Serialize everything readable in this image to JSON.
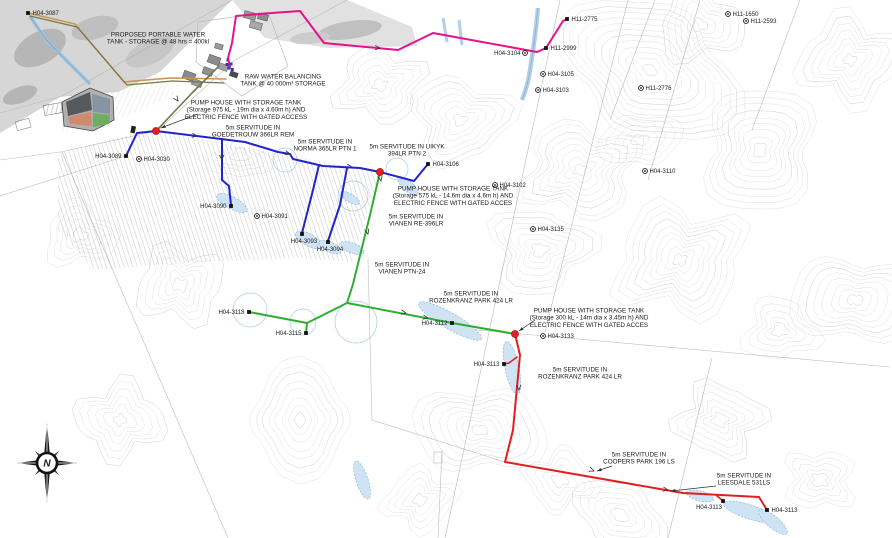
{
  "map": {
    "compass_label": "N",
    "colors": {
      "blue": "#2323cc",
      "green": "#2fae2f",
      "red": "#e02020",
      "pink": "#e6128c",
      "tan": "#c9964f",
      "olive": "#77774a",
      "junction": "#e02020",
      "marker": "#111111",
      "leader": "#333333"
    },
    "annotations": [
      {
        "id": "proposed-tank",
        "x": 158,
        "y": 31,
        "lines": [
          "PROPOSED PORTABLE WATER",
          "TANK - STORAGE @ 48 hrs = 400kl"
        ]
      },
      {
        "id": "raw-water-tank",
        "x": 283,
        "y": 73,
        "lines": [
          "RAW WATER BALANCING",
          "TANK @ 40 000m³ STORAGE"
        ]
      },
      {
        "id": "pump-house-1",
        "x": 246,
        "y": 99,
        "lines": [
          "PUMP HOUSE WITH STORAGE TANK",
          "(Storage 975 kL - 19m dia x 4.60m h) AND",
          "ELECTRIC FENCE WITH GATED ACCESS"
        ]
      },
      {
        "id": "servitude-goedetrouw",
        "x": 253,
        "y": 124,
        "lines": [
          "5m SERVITUDE IN",
          "GOEDETROUW 366LR REM"
        ]
      },
      {
        "id": "servitude-norma",
        "x": 325,
        "y": 138,
        "lines": [
          "5m SERVITUDE IN",
          "NORMA 365LR PTN 1"
        ]
      },
      {
        "id": "servitude-uikyk",
        "x": 407,
        "y": 143,
        "lines": [
          "5m SERVITUDE IN UIKYK",
          "394LR PTN 2"
        ]
      },
      {
        "id": "pump-house-2",
        "x": 453,
        "y": 185,
        "lines": [
          "PUMP HOUSE WITH STORAGE TANK",
          "(Storage 575 kL - 14.6m dia x 4.6m h) AND",
          "ELECTRIC FENCE WITH GATED ACCES"
        ]
      },
      {
        "id": "servitude-vianen-re",
        "x": 416,
        "y": 213,
        "lines": [
          "5m SERVITUDE IN",
          "VIANEN RE-396LR"
        ]
      },
      {
        "id": "servitude-vianen-ptn",
        "x": 402,
        "y": 261,
        "lines": [
          "5m SERVITUDE IN",
          "VIANEN PTN-24"
        ]
      },
      {
        "id": "servitude-rozenkranz-1",
        "x": 471,
        "y": 290,
        "lines": [
          "5m SERVITUDE IN",
          "ROZENKRANZ PARK 424 LR"
        ]
      },
      {
        "id": "pump-house-3",
        "x": 589,
        "y": 307,
        "lines": [
          "PUMP HOUSE WITH STORAGE TANK",
          "(Storage 300 kL - 14m dia x 3.45m h) AND",
          "ELECTRIC FENCE WITH GATED ACCES"
        ]
      },
      {
        "id": "servitude-rozenkranz-2",
        "x": 580,
        "y": 366,
        "lines": [
          "5m SERVITUDE IN",
          "ROZENKRANZ PARK 424 LR"
        ]
      },
      {
        "id": "servitude-coopers",
        "x": 639,
        "y": 451,
        "lines": [
          "5m SERVITUDE IN",
          "COOPERS PARK 196 LS"
        ]
      },
      {
        "id": "servitude-leesdale",
        "x": 744,
        "y": 472,
        "lines": [
          "5m SERVITUDE IN",
          "LEESDALE 531LS"
        ]
      }
    ],
    "markers": [
      {
        "label": "H04-3087",
        "x": 28,
        "y": 13,
        "type": "node",
        "side": "right"
      },
      {
        "label": "H11-2775",
        "x": 567,
        "y": 19,
        "type": "node",
        "side": "right"
      },
      {
        "label": "H11-1650",
        "x": 728,
        "y": 14,
        "type": "survey",
        "side": "right"
      },
      {
        "label": "H11-2593",
        "x": 746,
        "y": 21,
        "type": "survey",
        "side": "right"
      },
      {
        "label": "H11-2999",
        "x": 546,
        "y": 48,
        "type": "node",
        "side": "right"
      },
      {
        "label": "H04-3104",
        "x": 525,
        "y": 53,
        "type": "survey",
        "side": "left"
      },
      {
        "label": "H04-3105",
        "x": 543,
        "y": 74,
        "type": "survey",
        "side": "right"
      },
      {
        "label": "H04-3103",
        "x": 538,
        "y": 90,
        "type": "survey",
        "side": "right"
      },
      {
        "label": "H11-2776",
        "x": 641,
        "y": 88,
        "type": "survey",
        "side": "right"
      },
      {
        "label": "H04-3110",
        "x": 645,
        "y": 171,
        "type": "survey",
        "side": "right"
      },
      {
        "label": "H04-3089",
        "x": 126,
        "y": 156,
        "type": "node",
        "side": "left"
      },
      {
        "label": "H04-3030",
        "x": 139,
        "y": 159,
        "type": "survey",
        "side": "right"
      },
      {
        "label": "H04-3090",
        "x": 231,
        "y": 206,
        "type": "node",
        "side": "left"
      },
      {
        "label": "H04-3091",
        "x": 257,
        "y": 216,
        "type": "survey",
        "side": "right"
      },
      {
        "label": "H04-3093",
        "x": 302,
        "y": 234,
        "type": "node",
        "side": "below"
      },
      {
        "label": "H04-3094",
        "x": 328,
        "y": 242,
        "type": "node",
        "side": "below"
      },
      {
        "label": "H04-3106",
        "x": 428,
        "y": 164,
        "type": "node",
        "side": "right"
      },
      {
        "label": "H04-3102",
        "x": 495,
        "y": 185,
        "type": "survey",
        "side": "right"
      },
      {
        "label": "H04-3135",
        "x": 533,
        "y": 229,
        "type": "survey",
        "side": "right"
      },
      {
        "label": "H04-3118",
        "x": 249,
        "y": 312,
        "type": "node",
        "side": "left"
      },
      {
        "label": "H04-3115",
        "x": 306,
        "y": 333,
        "type": "node",
        "side": "left"
      },
      {
        "label": "H04-3112",
        "x": 452,
        "y": 323,
        "type": "node",
        "side": "left"
      },
      {
        "label": "H04-3133",
        "x": 543,
        "y": 336,
        "type": "survey",
        "side": "right"
      },
      {
        "label": "H04-3113",
        "x": 504,
        "y": 364,
        "type": "node",
        "side": "left"
      },
      {
        "label": "H04-3113",
        "x": 723,
        "y": 501,
        "type": "node",
        "side": "below-left"
      },
      {
        "label": "H04-3113",
        "x": 767,
        "y": 510,
        "type": "node",
        "side": "right"
      }
    ],
    "junctions": [
      {
        "x": 156,
        "y": 131
      },
      {
        "x": 380,
        "y": 172
      },
      {
        "x": 515,
        "y": 334
      }
    ],
    "pipelines": [
      {
        "name": "raw-line-tan",
        "color": "tan",
        "width": 1.6,
        "points": [
          [
            28,
            13
          ],
          [
            75,
            24
          ],
          [
            124,
            82
          ],
          [
            170,
            78
          ],
          [
            226,
            79
          ]
        ]
      },
      {
        "name": "raw-line-olive",
        "color": "olive",
        "width": 1.2,
        "points": [
          [
            30,
            16
          ],
          [
            77,
            27
          ],
          [
            127,
            85
          ],
          [
            172,
            81
          ],
          [
            224,
            83
          ]
        ]
      },
      {
        "name": "gravity-line",
        "color": "olive",
        "width": 1.6,
        "points": [
          [
            219,
            66
          ],
          [
            192,
            93
          ],
          [
            156,
            131
          ]
        ]
      },
      {
        "name": "rising-main-pink",
        "color": "pink",
        "width": 2,
        "points": [
          [
            230,
            67
          ],
          [
            228,
            58
          ],
          [
            232,
            43
          ],
          [
            236,
            16
          ],
          [
            272,
            13
          ],
          [
            300,
            11
          ],
          [
            324,
            43
          ],
          [
            398,
            50
          ],
          [
            433,
            33
          ],
          [
            537,
            52
          ],
          [
            546,
            48
          ],
          [
            563,
            21
          ],
          [
            567,
            19
          ]
        ]
      },
      {
        "name": "goedetrouw-main-blue",
        "color": "blue",
        "width": 2,
        "points": [
          [
            137,
            133
          ],
          [
            156,
            131
          ],
          [
            213,
            138
          ],
          [
            245,
            142
          ],
          [
            278,
            152
          ],
          [
            290,
            154
          ],
          [
            293,
            159
          ],
          [
            323,
            166
          ],
          [
            360,
            168
          ],
          [
            380,
            172
          ]
        ]
      },
      {
        "name": "blue-tail-uikyk",
        "color": "blue",
        "width": 2,
        "points": [
          [
            380,
            172
          ],
          [
            414,
            181
          ],
          [
            428,
            164
          ]
        ]
      },
      {
        "name": "blue-branch-3089",
        "color": "blue",
        "width": 2,
        "points": [
          [
            137,
            133
          ],
          [
            126,
            156
          ]
        ]
      },
      {
        "name": "blue-branch-3090",
        "color": "blue",
        "width": 2,
        "points": [
          [
            222,
            139
          ],
          [
            222,
            180
          ],
          [
            229,
            186
          ],
          [
            231,
            205
          ]
        ]
      },
      {
        "name": "blue-branch-3093",
        "color": "blue",
        "width": 2,
        "points": [
          [
            319,
            165
          ],
          [
            313,
            190
          ],
          [
            302,
            233
          ]
        ]
      },
      {
        "name": "blue-branch-3094",
        "color": "blue",
        "width": 2,
        "points": [
          [
            347,
            168
          ],
          [
            340,
            205
          ],
          [
            328,
            241
          ]
        ]
      },
      {
        "name": "green-main",
        "color": "green",
        "width": 2,
        "points": [
          [
            380,
            172
          ],
          [
            370,
            215
          ],
          [
            353,
            284
          ],
          [
            347,
            303
          ]
        ]
      },
      {
        "name": "green-rozenkranz",
        "color": "green",
        "width": 2,
        "points": [
          [
            347,
            303
          ],
          [
            452,
            323
          ],
          [
            515,
            334
          ]
        ]
      },
      {
        "name": "green-branch-west",
        "color": "green",
        "width": 2,
        "points": [
          [
            347,
            303
          ],
          [
            307,
            323
          ]
        ]
      },
      {
        "name": "green-branch-3118",
        "color": "green",
        "width": 2,
        "points": [
          [
            307,
            323
          ],
          [
            249,
            312
          ]
        ]
      },
      {
        "name": "green-branch-3115",
        "color": "green",
        "width": 2,
        "points": [
          [
            307,
            323
          ],
          [
            306,
            333
          ]
        ]
      },
      {
        "name": "red-main",
        "color": "red",
        "width": 2,
        "points": [
          [
            515,
            334
          ],
          [
            520,
            355
          ],
          [
            513,
            430
          ],
          [
            505,
            462
          ],
          [
            683,
            493
          ],
          [
            759,
            497
          ],
          [
            767,
            510
          ]
        ]
      },
      {
        "name": "red-stub-3113a",
        "color": "red",
        "width": 1.6,
        "points": [
          [
            517,
            357
          ],
          [
            509,
            363
          ],
          [
            504,
            364
          ]
        ]
      },
      {
        "name": "red-stub-3113b",
        "color": "red",
        "width": 1.6,
        "points": [
          [
            716,
            495
          ],
          [
            723,
            501
          ]
        ]
      }
    ],
    "flow_ticks": [
      {
        "x": 197,
        "y": 136,
        "a": 9
      },
      {
        "x": 290,
        "y": 154,
        "a": 16
      },
      {
        "x": 352,
        "y": 167,
        "a": 8
      },
      {
        "x": 222,
        "y": 160,
        "a": 85
      },
      {
        "x": 368,
        "y": 234,
        "a": 75
      },
      {
        "x": 381,
        "y": 181,
        "a": 78
      },
      {
        "x": 406,
        "y": 313,
        "a": 11
      },
      {
        "x": 428,
        "y": 318,
        "a": 10
      },
      {
        "x": 519,
        "y": 390,
        "a": 86
      },
      {
        "x": 594,
        "y": 471,
        "a": 22
      },
      {
        "x": 668,
        "y": 490,
        "a": 10
      },
      {
        "x": 380,
        "y": 48,
        "a": 4
      },
      {
        "x": 178,
        "y": 101,
        "a": 55
      }
    ],
    "leaders": [
      {
        "from": [
          198,
          114
        ],
        "to": [
          161,
          128
        ]
      },
      {
        "from": [
          535,
          320
        ],
        "to": [
          519,
          331
        ]
      },
      {
        "from": [
          612,
          466
        ],
        "to": [
          597,
          471
        ]
      },
      {
        "from": [
          716,
          486
        ],
        "to": [
          671,
          491
        ]
      }
    ]
  }
}
